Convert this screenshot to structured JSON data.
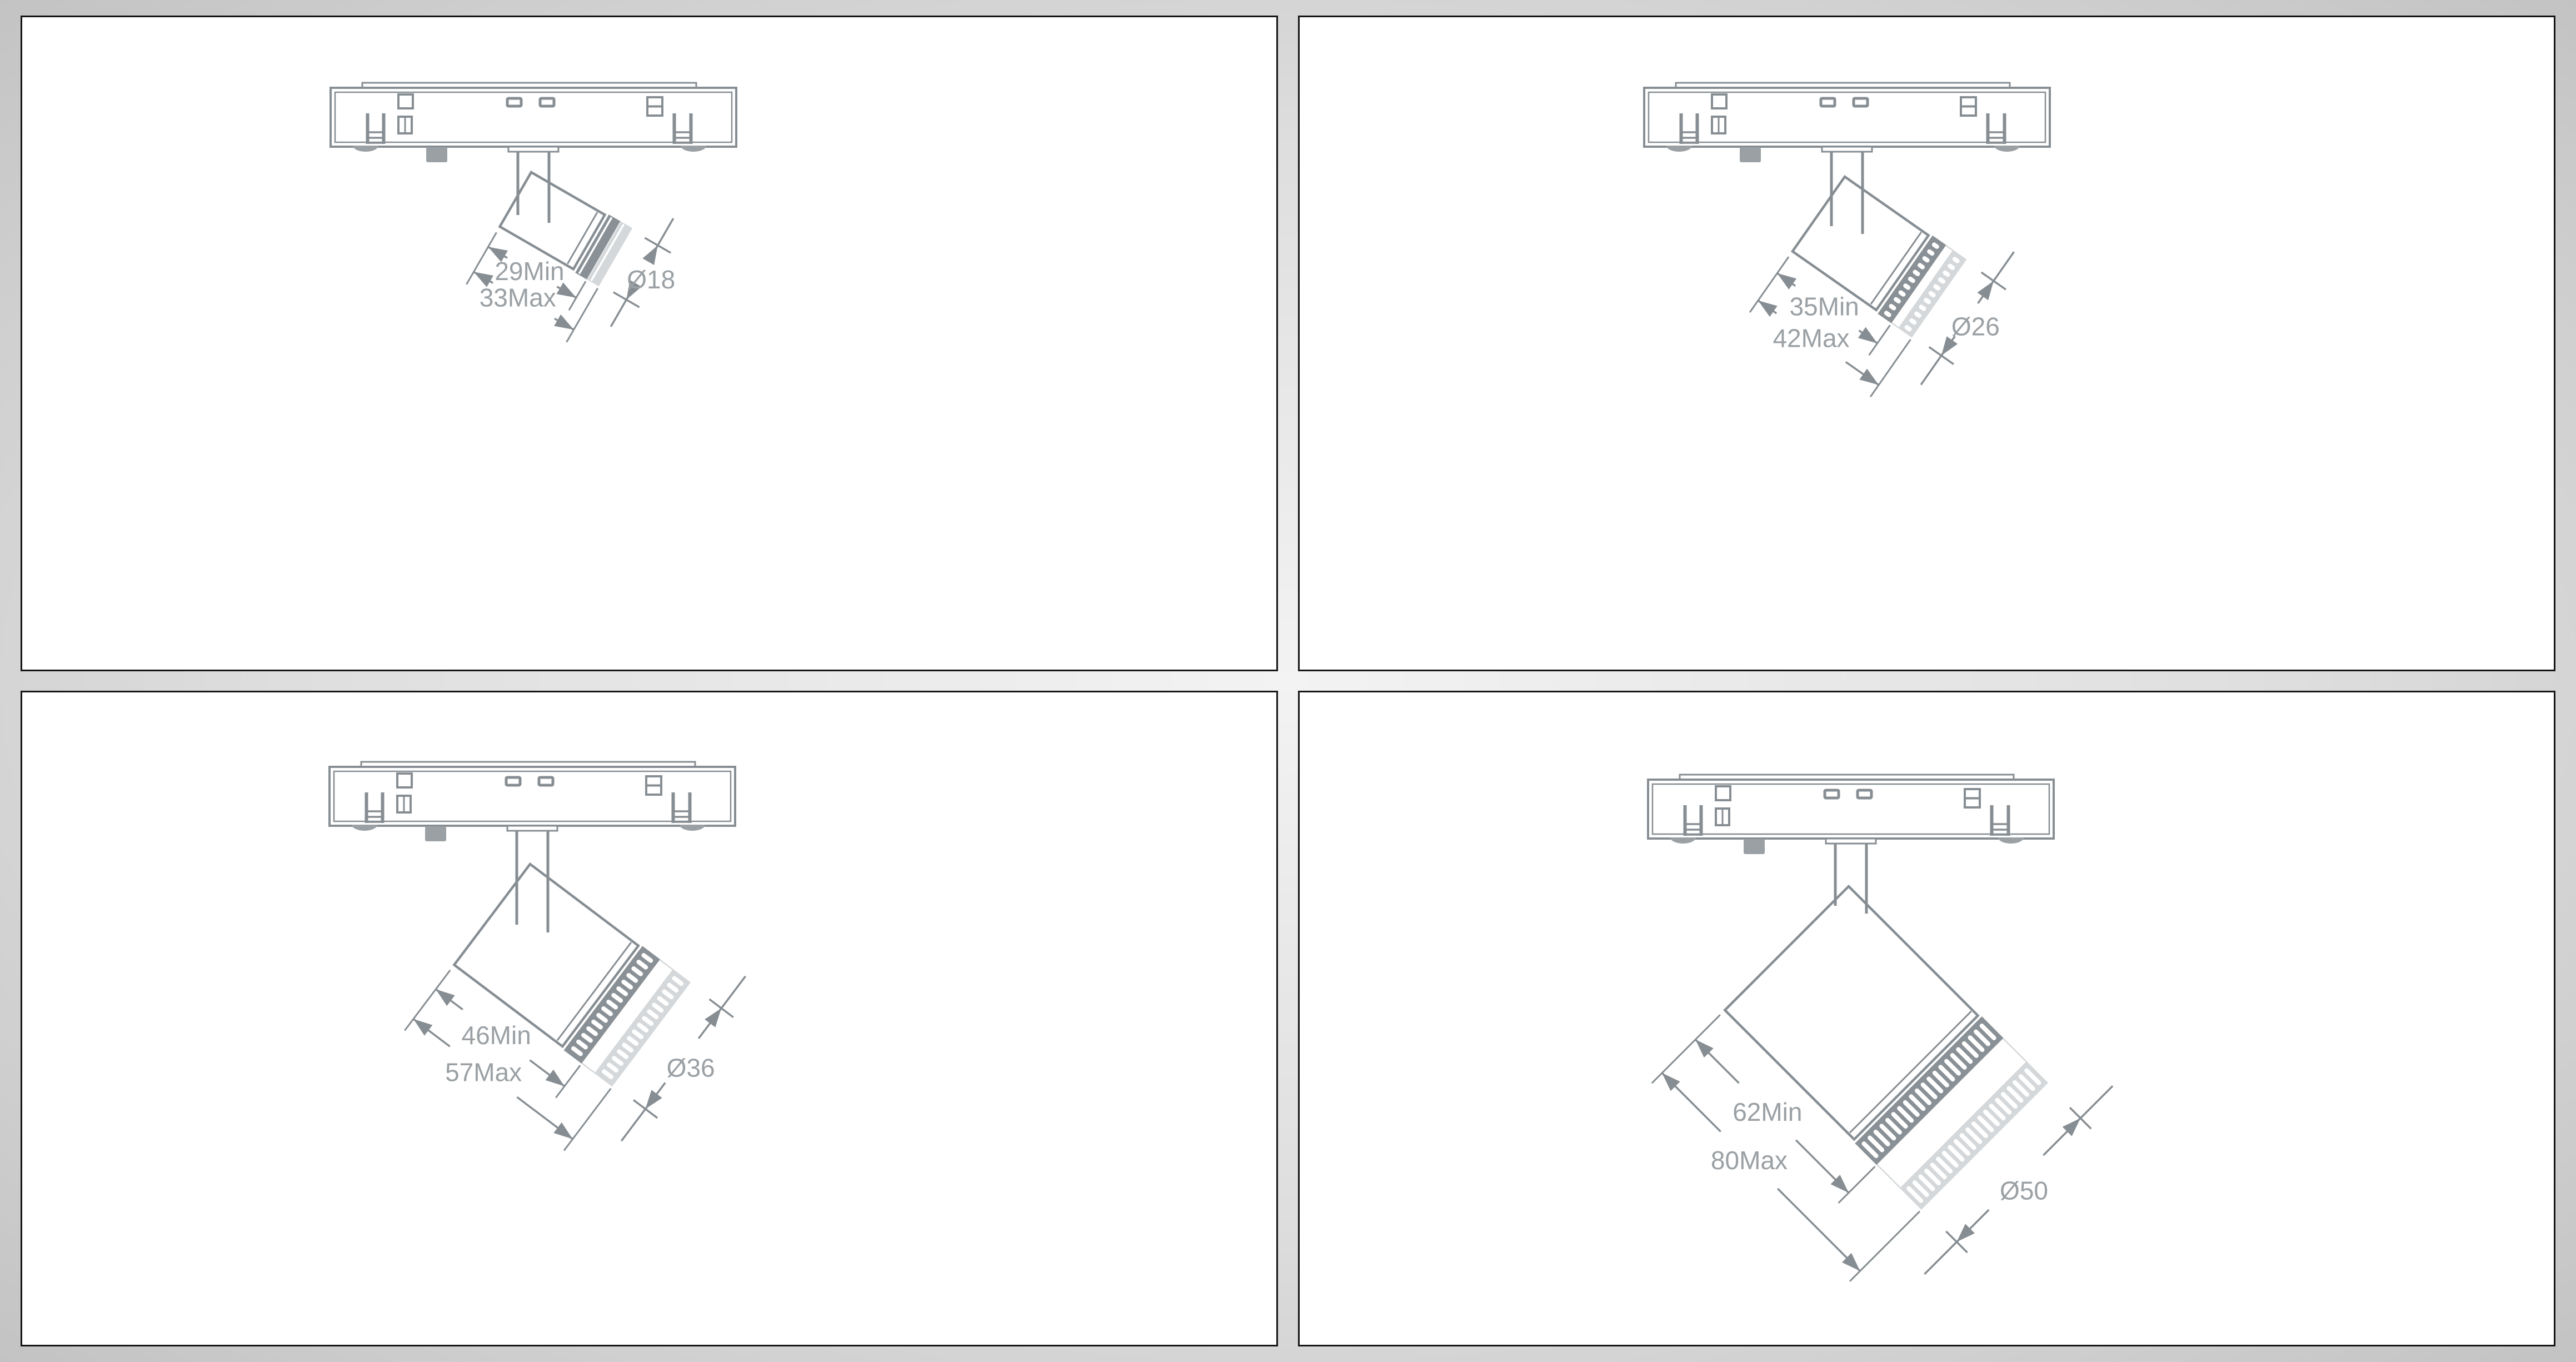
{
  "document": {
    "title": "Magnetic track spotlight dimension drawings",
    "panel_count": 4
  },
  "colors": {
    "line": "#878e93",
    "band": "#8a9196",
    "ghost": "#d5d8da",
    "fill": "#9aa0a4",
    "text": "#9aa0a4",
    "panel_border": "#161616",
    "panel_bg": "#ffffff"
  },
  "panels": [
    {
      "id": "top-left",
      "labels": {
        "min": "29Min",
        "max": "33Max",
        "dia": "Ø18"
      },
      "dimensions_mm": {
        "length_min": 29,
        "length_max": 33,
        "diameter": 18
      }
    },
    {
      "id": "top-right",
      "labels": {
        "min": "35Min",
        "max": "42Max",
        "dia": "Ø26"
      },
      "dimensions_mm": {
        "length_min": 35,
        "length_max": 42,
        "diameter": 26
      }
    },
    {
      "id": "bottom-left",
      "labels": {
        "min": "46Min",
        "max": "57Max",
        "dia": "Ø36"
      },
      "dimensions_mm": {
        "length_min": 46,
        "length_max": 57,
        "diameter": 36
      }
    },
    {
      "id": "bottom-right",
      "labels": {
        "min": "62Min",
        "max": "80Max",
        "dia": "Ø50"
      },
      "dimensions_mm": {
        "length_min": 62,
        "length_max": 80,
        "diameter": 50
      }
    }
  ]
}
